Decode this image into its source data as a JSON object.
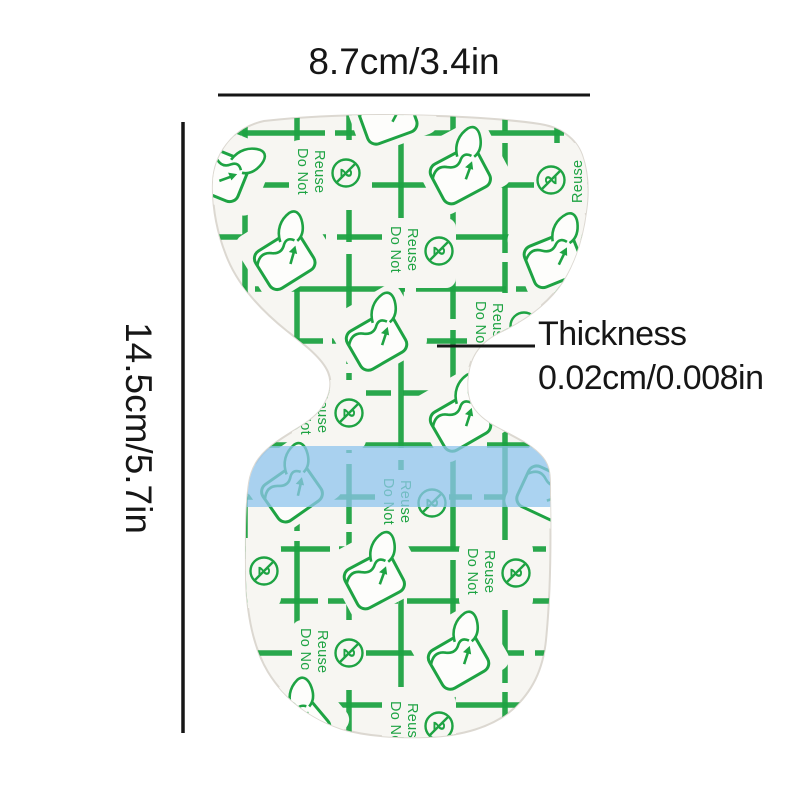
{
  "product_diagram": {
    "width_label": "8.7cm/3.4in",
    "height_label": "14.5cm/5.7in",
    "thickness_title": "Thickness",
    "thickness_value": "0.02cm/0.008in"
  },
  "patch": {
    "warning_line1": "Do Not",
    "warning_line2": "Reuse",
    "no_reuse_digit": "2",
    "colors": {
      "print_green": "#1ea343",
      "film_white": "#f7f6f2",
      "sheet_white": "#fdfdfb",
      "strip_blue": "#8fc4ee",
      "edge_gray": "#dcd8d1",
      "label_black": "#161616"
    }
  },
  "icons": {
    "do_not_reuse": "crossed-circle-2-icon",
    "peel_film": "peeling-film-arrow-icon"
  }
}
